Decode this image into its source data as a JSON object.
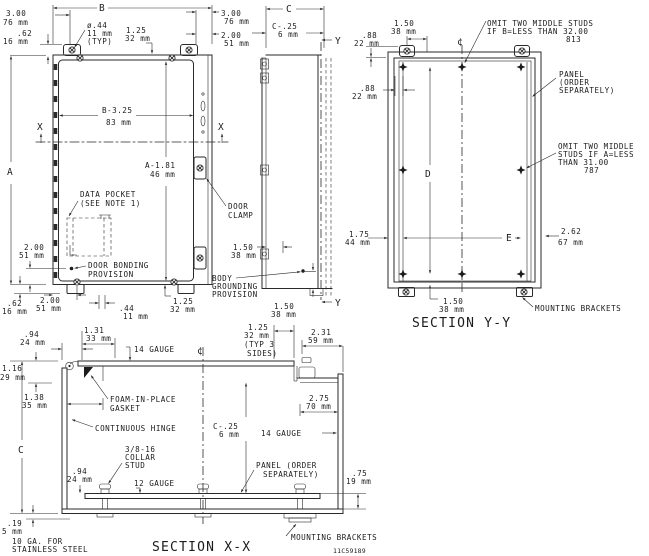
{
  "title_block": {
    "drawing_number": "11C59189"
  },
  "front_view": {
    "dim_width": "B",
    "dim_height": "A",
    "cut_label": "X",
    "dim_bracket_3_00": [
      "3.00",
      "76 mm"
    ],
    "dim_tab_62": [
      ".62",
      "16 mm"
    ],
    "hole_callout": [
      "ø.44",
      "11 mm",
      "(TYP)"
    ],
    "dim_1_25_top": [
      "1.25",
      "32 mm"
    ],
    "dim_3_00_right": [
      "3.00",
      "76 mm"
    ],
    "dim_2_00_right": [
      "2.00",
      "51 mm"
    ],
    "dim_panel_width": [
      "B-3.25",
      "83 mm"
    ],
    "dim_panel_height": [
      "A-1.81",
      "46 mm"
    ],
    "data_pocket_note": [
      "DATA POCKET",
      "(SEE NOTE 1)"
    ],
    "door_bonding_note": [
      "DOOR BONDING",
      "PROVISION"
    ],
    "dim_2_00_left": [
      "2.00",
      "51 mm"
    ],
    "dim_62_bottom": [
      ".62",
      "16 mm"
    ],
    "dim_2_00_bottom": [
      "2.00",
      "51 mm"
    ],
    "dim_44_bottom": [
      ".44",
      "11 mm"
    ],
    "dim_1_25_bottom": [
      "1.25",
      "32 mm"
    ]
  },
  "side_view": {
    "dim_depth": "C",
    "dim_c_25": [
      "C-.25",
      "6 mm"
    ],
    "cut_label": "Y",
    "door_clamp_note": [
      "DOOR",
      "CLAMP"
    ],
    "dim_1_50_grounding": [
      "1.50",
      "38 mm"
    ],
    "body_grounding_note": [
      "BODY",
      "GROUNDING",
      "PROVISION"
    ],
    "dim_1_50_bottom": [
      "1.50",
      "38 mm"
    ]
  },
  "section_yy": {
    "title": "SECTION Y-Y",
    "centerline": "¢",
    "dim_88_tab": [
      ".88",
      "22 mm"
    ],
    "dim_1_50_stud": [
      "1.50",
      "38 mm"
    ],
    "omit_studs_b_note": [
      "OMIT TWO MIDDLE STUDS",
      "IF B=LESS THAN 32.00",
      "813"
    ],
    "panel_note": [
      "PANEL",
      "(ORDER",
      "SEPARATELY)"
    ],
    "dim_88_stud": [
      ".88",
      "22 mm"
    ],
    "omit_studs_a_note": [
      "OMIT TWO MIDDLE",
      "STUDS IF A=LESS",
      "THAN 31.00",
      "787"
    ],
    "dim_stud_span_v": "D",
    "dim_stud_span_h": "E",
    "dim_1_75": [
      "1.75",
      "44 mm"
    ],
    "dim_2_62": [
      "2.62",
      "67 mm"
    ],
    "dim_1_50_bracket": [
      "1.50",
      "38 mm"
    ],
    "mounting_brackets_note": "MOUNTING BRACKETS"
  },
  "section_xx": {
    "title": "SECTION X-X",
    "centerline": "¢",
    "dim_94_hinge": [
      ".94",
      "24 mm"
    ],
    "dim_1_31": [
      "1.31",
      "33 mm"
    ],
    "door_gauge_note": "14 GAUGE",
    "dim_1_16": [
      "1.16",
      "29 mm"
    ],
    "dim_1_38": [
      "1.38",
      "35 mm"
    ],
    "gasket_note": [
      "FOAM-IN-PLACE",
      "GASKET"
    ],
    "hinge_note": "CONTINUOUS HINGE",
    "dim_1_25_typ": [
      "1.25",
      "32 mm",
      "(TYP 3",
      "SIDES)"
    ],
    "dim_2_31": [
      "2.31",
      "59 mm"
    ],
    "dim_2_75": [
      "2.75",
      "70 mm"
    ],
    "dim_c_25": [
      "C-.25",
      "6 mm"
    ],
    "wall_gauge_note": "14 GAUGE",
    "dim_depth": "C",
    "collar_stud_note": [
      "3/8-16",
      "COLLAR",
      "STUD"
    ],
    "dim_94_stud": [
      ".94",
      "24 mm"
    ],
    "panel_gauge_note": "12 GAUGE",
    "panel_note": [
      "PANEL (ORDER",
      "SEPARATELY)"
    ],
    "dim_75": [
      ".75",
      "19 mm"
    ],
    "dim_19": [
      ".19",
      "5 mm"
    ],
    "stainless_note": [
      "10 GA. FOR",
      "STAINLESS STEEL"
    ],
    "mounting_brackets_note": "MOUNTING BRACKETS"
  }
}
